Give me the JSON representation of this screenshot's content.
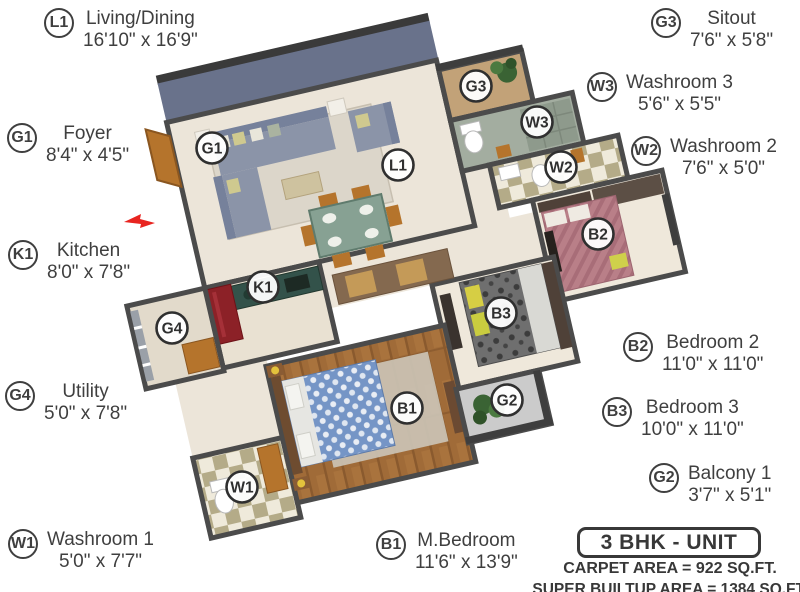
{
  "title_box": {
    "label": "3 BHK - UNIT"
  },
  "area_lines": {
    "carpet": "CARPET AREA = 922 SQ.FT.",
    "super_builtup": "SUPER BUILTUP AREA = 1384 SQ.FT."
  },
  "rooms": [
    {
      "code": "L1",
      "name": "Living/Dining",
      "dims": "16'10\" x 16'9\""
    },
    {
      "code": "G3",
      "name": "Sitout",
      "dims": "7'6\" x 5'8\""
    },
    {
      "code": "W3",
      "name": "Washroom 3",
      "dims": "5'6\" x 5'5\""
    },
    {
      "code": "W2",
      "name": "Washroom 2",
      "dims": "7'6\" x 5'0\""
    },
    {
      "code": "G1",
      "name": "Foyer",
      "dims": "8'4\" x 4'5\""
    },
    {
      "code": "K1",
      "name": "Kitchen",
      "dims": "8'0\" x 7'8\""
    },
    {
      "code": "G4",
      "name": "Utility",
      "dims": "5'0\" x 7'8\""
    },
    {
      "code": "W1",
      "name": "Washroom 1",
      "dims": "5'0\" x 7'7\""
    },
    {
      "code": "B2",
      "name": "Bedroom 2",
      "dims": "11'0\" x 11'0\""
    },
    {
      "code": "B3",
      "name": "Bedroom 3",
      "dims": "10'0\" x 11'0\""
    },
    {
      "code": "G2",
      "name": "Balcony 1",
      "dims": "3'7\" x 5'1\""
    },
    {
      "code": "B1",
      "name": "M.Bedroom",
      "dims": "11'6\" x 13'9\""
    }
  ],
  "colors": {
    "accent_wall": "#69728b",
    "wall": "#4b4b4b",
    "floor": "#ece5d9",
    "wood_floor": "#a06b38",
    "bed_master": "#7595c6",
    "bed_2": "#b97f88",
    "bed_3": "#6f6f6f",
    "sofa": "#8b94a8",
    "kitchen_counter": "#33524a",
    "fridge": "#8c2127",
    "door_wood": "#b5742c",
    "entry_arrow": "#e82420",
    "plant": "#3a6334"
  }
}
